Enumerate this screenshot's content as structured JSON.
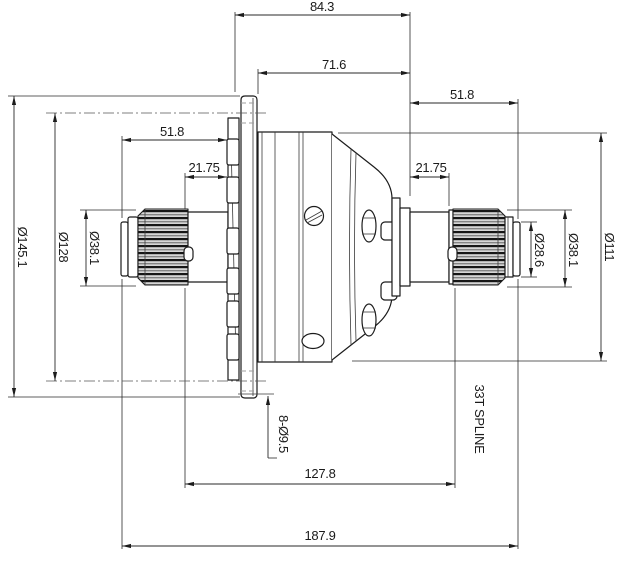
{
  "colors": {
    "background": "#ffffff",
    "line": "#1c1c1c",
    "hidden_line": "#9c9c9c",
    "spline_fill": "#d6d6d6"
  },
  "dims": {
    "top_overall": "84.3",
    "body_span": "71.6",
    "right_spline_len": "51.8",
    "left_shaft_len": "51.8",
    "left_hub_len": "21.75",
    "right_hub_len": "21.75",
    "case_span": "127.8",
    "overall_length": "187.9",
    "flange_dia": "Ø145.1",
    "bolt_circle_dia": "Ø128",
    "left_spline_dia": "Ø38.1",
    "right_spline_dia": "Ø38.1",
    "shaft_end_dia": "Ø28.6",
    "case_dia": "Ø111",
    "bolt_holes": "8-Ø9.5",
    "spline_note": "33T SPLINE"
  }
}
